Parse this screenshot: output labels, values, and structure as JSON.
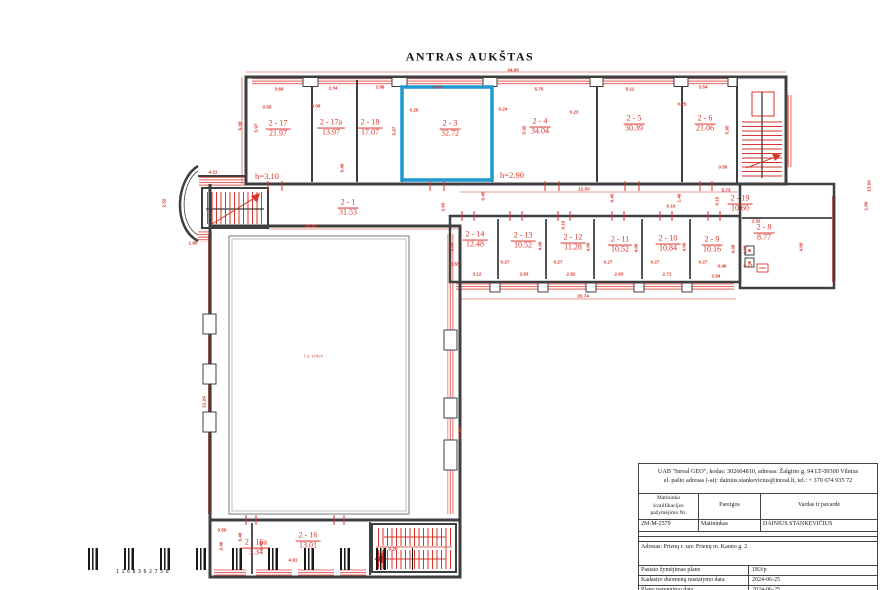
{
  "title": "ANTRAS AUKŠTAS",
  "colors": {
    "highlight": "#1e9ad2",
    "dimension_red": "#d9352c",
    "wall_gray": "#3f3f3f",
    "hatch_red": "#e4615a"
  },
  "plan": {
    "hall_label": "1 a. erdvė",
    "highlighted_room": "2 - 3",
    "height_labels": [
      {
        "text": "h=3.10",
        "x": 267,
        "y": 176
      },
      {
        "text": "h=2.90",
        "x": 512,
        "y": 175
      }
    ],
    "rooms": [
      {
        "id": "2 - 17",
        "area": "21.97",
        "x": 278,
        "y": 129
      },
      {
        "id": "2 - 17a",
        "area": "13.97",
        "x": 331,
        "y": 128
      },
      {
        "id": "2 - 18",
        "area": "17.07",
        "x": 370,
        "y": 128
      },
      {
        "id": "2 - 3",
        "area": "32.72",
        "x": 450,
        "y": 129
      },
      {
        "id": "2 - 4",
        "area": "34.04",
        "x": 540,
        "y": 127
      },
      {
        "id": "2 - 5",
        "area": "30.39",
        "x": 634,
        "y": 124
      },
      {
        "id": "2 - 6",
        "area": "21.06",
        "x": 705,
        "y": 124
      },
      {
        "id": "2 - 1",
        "area": "31.53",
        "x": 348,
        "y": 208
      },
      {
        "id": "2 - 19",
        "area": "10.60",
        "x": 740,
        "y": 204
      },
      {
        "id": "2 - 14",
        "area": "12.48",
        "x": 475,
        "y": 240
      },
      {
        "id": "2 - 13",
        "area": "10.52",
        "x": 523,
        "y": 241
      },
      {
        "id": "2 - 12",
        "area": "11.28",
        "x": 573,
        "y": 243
      },
      {
        "id": "2 - 11",
        "area": "10.52",
        "x": 620,
        "y": 245
      },
      {
        "id": "2 - 10",
        "area": "10.84",
        "x": 668,
        "y": 244
      },
      {
        "id": "2 - 9",
        "area": "10.16",
        "x": 712,
        "y": 245
      },
      {
        "id": "2 - 8",
        "area": "8.77",
        "x": 764,
        "y": 233
      },
      {
        "id": "2 - 16a",
        "area": "3.34",
        "x": 256,
        "y": 548
      },
      {
        "id": "2 - 16",
        "area": "13.01",
        "x": 308,
        "y": 541
      }
    ],
    "dims": [
      {
        "t": "34.00",
        "x": 513,
        "y": 70
      },
      {
        "t": "3.68",
        "x": 279,
        "y": 89
      },
      {
        "t": "2.34",
        "x": 333,
        "y": 88
      },
      {
        "t": "2.86",
        "x": 380,
        "y": 87
      },
      {
        "t": "5.48",
        "x": 437,
        "y": 87
      },
      {
        "t": "5.75",
        "x": 539,
        "y": 89
      },
      {
        "t": "5.11",
        "x": 630,
        "y": 89
      },
      {
        "t": "3.54",
        "x": 703,
        "y": 87
      },
      {
        "t": "0.55",
        "x": 267,
        "y": 107
      },
      {
        "t": "0.08",
        "x": 316,
        "y": 106
      },
      {
        "t": "0.25",
        "x": 414,
        "y": 110
      },
      {
        "t": "0.24",
        "x": 503,
        "y": 109
      },
      {
        "t": "0.23",
        "x": 574,
        "y": 112
      },
      {
        "t": "0.25",
        "x": 682,
        "y": 104
      },
      {
        "t": "0.50",
        "x": 723,
        "y": 167
      },
      {
        "t": "6.38",
        "x": 240,
        "y": 126,
        "r": 1
      },
      {
        "t": "5.97",
        "x": 256,
        "y": 128,
        "r": 1
      },
      {
        "t": "5.97",
        "x": 394,
        "y": 131,
        "r": 1
      },
      {
        "t": "5.95",
        "x": 524,
        "y": 130,
        "r": 1
      },
      {
        "t": "5.95",
        "x": 727,
        "y": 130,
        "r": 1
      },
      {
        "t": "0.48",
        "x": 342,
        "y": 168,
        "r": 1
      },
      {
        "t": "4.21",
        "x": 213,
        "y": 172
      },
      {
        "t": "1.80",
        "x": 193,
        "y": 243
      },
      {
        "t": "2.52",
        "x": 164,
        "y": 203,
        "r": 1
      },
      {
        "t": "16.80",
        "x": 311,
        "y": 226
      },
      {
        "t": "12.50",
        "x": 584,
        "y": 189
      },
      {
        "t": "5.73",
        "x": 726,
        "y": 190
      },
      {
        "t": "2.65",
        "x": 443,
        "y": 207,
        "r": 1
      },
      {
        "t": "0.45",
        "x": 612,
        "y": 198,
        "r": 1
      },
      {
        "t": "1.40",
        "x": 679,
        "y": 198,
        "r": 1
      },
      {
        "t": "0.16",
        "x": 671,
        "y": 206
      },
      {
        "t": "0.15",
        "x": 717,
        "y": 201,
        "r": 1
      },
      {
        "t": "0.48",
        "x": 483,
        "y": 196,
        "r": 1
      },
      {
        "t": "13.50",
        "x": 869,
        "y": 186,
        "r": 1
      },
      {
        "t": "1.80",
        "x": 866,
        "y": 206,
        "r": 1
      },
      {
        "t": "2.32",
        "x": 756,
        "y": 221
      },
      {
        "t": "0.47",
        "x": 748,
        "y": 266
      },
      {
        "t": "0.49",
        "x": 722,
        "y": 266
      },
      {
        "t": "2.54",
        "x": 716,
        "y": 276
      },
      {
        "t": "3.12",
        "x": 477,
        "y": 274
      },
      {
        "t": "2.63",
        "x": 524,
        "y": 274
      },
      {
        "t": "2.82",
        "x": 571,
        "y": 274
      },
      {
        "t": "2.63",
        "x": 619,
        "y": 274
      },
      {
        "t": "2.71",
        "x": 667,
        "y": 274
      },
      {
        "t": "0.55",
        "x": 455,
        "y": 264
      },
      {
        "t": "0.27",
        "x": 505,
        "y": 262
      },
      {
        "t": "0.27",
        "x": 558,
        "y": 262
      },
      {
        "t": "0.27",
        "x": 608,
        "y": 262
      },
      {
        "t": "0.27",
        "x": 655,
        "y": 262
      },
      {
        "t": "0.27",
        "x": 703,
        "y": 262
      },
      {
        "t": "4.00",
        "x": 452,
        "y": 247,
        "r": 1
      },
      {
        "t": "4.00",
        "x": 540,
        "y": 246,
        "r": 1
      },
      {
        "t": "4.00",
        "x": 588,
        "y": 247,
        "r": 1
      },
      {
        "t": "4.00",
        "x": 636,
        "y": 248,
        "r": 1
      },
      {
        "t": "4.00",
        "x": 684,
        "y": 247,
        "r": 1
      },
      {
        "t": "4.00",
        "x": 733,
        "y": 249,
        "r": 1
      },
      {
        "t": "4.00",
        "x": 745,
        "y": 250,
        "r": 1
      },
      {
        "t": "4.00",
        "x": 801,
        "y": 247,
        "r": 1
      },
      {
        "t": "0.15",
        "x": 563,
        "y": 225,
        "r": 1
      },
      {
        "t": "20.74",
        "x": 583,
        "y": 296
      },
      {
        "t": "21.29",
        "x": 204,
        "y": 402,
        "r": 1
      },
      {
        "t": "17.90",
        "x": 460,
        "y": 433,
        "r": 1
      },
      {
        "t": "0.55",
        "x": 222,
        "y": 530
      },
      {
        "t": "0.48",
        "x": 240,
        "y": 537,
        "r": 1
      },
      {
        "t": "2.46",
        "x": 221,
        "y": 546,
        "r": 1
      },
      {
        "t": "2.45",
        "x": 261,
        "y": 546,
        "r": 1
      },
      {
        "t": "4.91",
        "x": 293,
        "y": 560
      },
      {
        "t": "0.26",
        "x": 393,
        "y": 549
      },
      {
        "t": "0.55",
        "x": 381,
        "y": 557,
        "r": 1
      }
    ]
  },
  "barcode": {
    "digits": "1168362750"
  },
  "titleblock": {
    "header_line1": "UAB \"Inreal GEO\", kodas: 302604810, adresas: Žalgirio g. 94 LT-09300 Vilnius",
    "header_line2": "el. pašto adresas (-ai): dainius.stankevicius@inreal.lt, tel.: + 370 674 935 72",
    "col1": "Matininko kvalifikacijos pažymėjimo Nr.",
    "col2": "Pareigos",
    "col3": "Vardas ir pavardė",
    "cert_no": "2M-M-2579",
    "position": "Matininkas",
    "name": "DAINIUS STANKEVIČIUS",
    "address": "Adresas: Prienų r. sav. Prienų m. Kauno g. 2",
    "rows": [
      [
        "Pastato žymėjimas plane",
        "1B3/p"
      ],
      [
        "Kadastro duomenų nustatymo data",
        "2024-06-25"
      ],
      [
        "Plano parengimo data",
        "2024-06-25"
      ],
      [
        "Mastelis",
        "1:200"
      ]
    ]
  }
}
